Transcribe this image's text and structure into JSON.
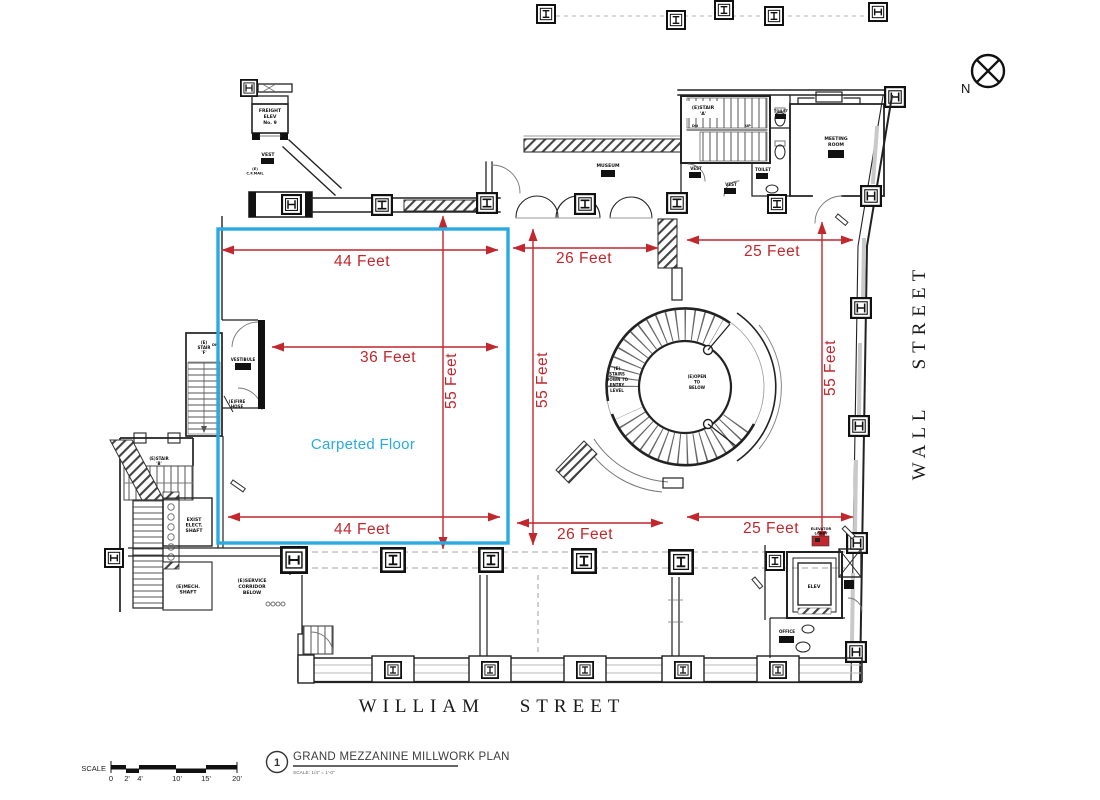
{
  "palette": {
    "dim": "#c1272d",
    "highlight": "#29abe2",
    "ink": "#1a1a1a"
  },
  "north": {
    "label": "N"
  },
  "streets": {
    "right": "WALL STREET",
    "bottom": "WILLIAM STREET"
  },
  "highlight": {
    "label": "Carpeted Floor"
  },
  "dims": {
    "w44a": "44 Feet",
    "w36": "36 Feet",
    "w44b": "44 Feet",
    "w26a": "26 Feet",
    "w26b": "26 Feet",
    "w25a": "25 Feet",
    "w25b": "25 Feet",
    "h55a": "55 Feet",
    "h55b": "55 Feet",
    "h55c": "55 Feet"
  },
  "rooms": {
    "freight_elev": [
      "FREIGHT",
      "ELEV",
      "No. 9"
    ],
    "vest_top": "VEST",
    "cf_mail": [
      "(E)",
      "C.F.MAIL"
    ],
    "stair_a": [
      "(E)STAIR",
      "'A'"
    ],
    "museum": "MUSEUM",
    "vest_1": "VEST",
    "vest_2": "VEST",
    "toilet_1": "TOILET",
    "toilet_2": "TOILET",
    "meeting_room": [
      "MEETING",
      "ROOM"
    ],
    "stair_f": [
      "(E)",
      "STAIR",
      "'F'"
    ],
    "vestibule": "VESTIBULE",
    "fire_hose": [
      "(E)FIRE",
      "HOSE"
    ],
    "stair_b": [
      "(E)STAIR",
      "'B'"
    ],
    "exist_elect": [
      "EXIST",
      "ELECT.",
      "SHAFT"
    ],
    "mech_shaft": [
      "(E)MECH.",
      "SHAFT"
    ],
    "service_corridor": [
      "(E)SERVICE",
      "CORRIDOR",
      "BELOW"
    ],
    "stairs_down": [
      "(E)",
      "STAIRS",
      "DOWN TO",
      "ENTRY",
      "LEVEL"
    ],
    "open_below": [
      "(E)OPEN",
      "TO",
      "BELOW"
    ],
    "elevator_lobby": [
      "ELEVATOR",
      "LOBBY"
    ],
    "elev": "ELEV",
    "office": "OFFICE",
    "dn": "DN",
    "up": "UP"
  },
  "titleblock": {
    "number": "1",
    "title": "GRAND MEZZANINE MILLWORK PLAN",
    "scale_note": "SCALE: 1/4\" = 1'-0\""
  },
  "scalebar": {
    "label": "SCALE",
    "ticks": [
      "0",
      "2'",
      "4'",
      "10'",
      "15'",
      "20'"
    ]
  }
}
